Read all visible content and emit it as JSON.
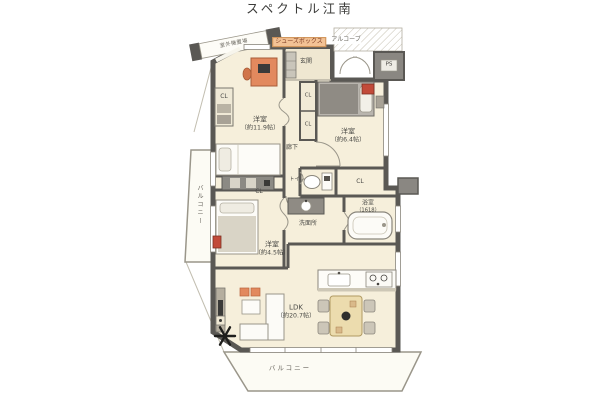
{
  "title": "スペクトル江南",
  "rooms": {
    "bedroom1": {
      "name": "洋室",
      "size": "（約11.9帖）"
    },
    "bedroom2": {
      "name": "洋室",
      "size": "（約6.4帖）"
    },
    "bedroom3": {
      "name": "洋室",
      "size": "（約4.5帖）"
    },
    "ldk": {
      "name": "LDK",
      "size": "（約20.7帖）"
    },
    "entrance": "玄関",
    "hallway": "廊下",
    "toilet": "トイレ",
    "washroom": "洗面所",
    "bathroom": {
      "name": "浴室",
      "size": "（1618）"
    }
  },
  "labels": {
    "closet": "CL",
    "pipe_space": "PS",
    "shoes_box": "シューズボックス",
    "alcove": "アルコーブ",
    "outdoor_unit": "室外機置場",
    "balcony": "バルコニー"
  },
  "colors": {
    "wall": "#5a5854",
    "room_fill": "#f6efdb",
    "entrance_tile": "#efe7d1",
    "balcony_fill": "#fcfbf4",
    "accent_orange": "#e2895e",
    "accent_red": "#c24b3a",
    "shoes_box_bg": "#f3c295",
    "shoes_box_text": "#7c3a22",
    "label_text": "#4a4a46"
  }
}
